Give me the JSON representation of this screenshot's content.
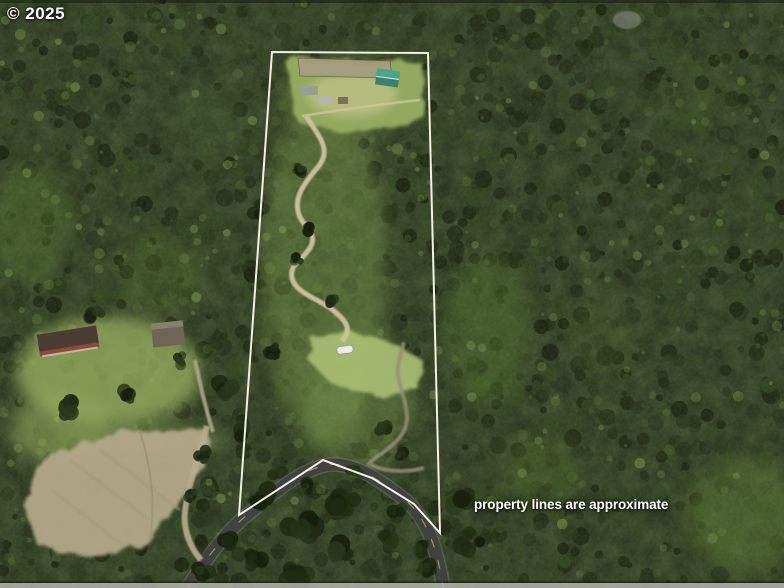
{
  "watermark": {
    "text": "© 2025"
  },
  "disclaimer": {
    "text": "property lines are approximate"
  },
  "palette": {
    "forest_base": "#222e18",
    "forest_dark": "#17210e",
    "forest_mid": "#31451f",
    "forest_light": "#527031",
    "brush_light": "#87a653",
    "meadow": "#aabf74",
    "grass_clearing": "#97ad60",
    "dirt_field": "#b3a88a",
    "dirt_road": "#cfc3a0",
    "paved_road": "#3f423f",
    "road_centerline": "#d8c24a",
    "creek": "#978d79",
    "boundary_line": "#faf8ea",
    "barn_roof": "#4aa38b",
    "barn_roof_shade": "#37826d",
    "shed_gray": "#98a095",
    "shed_light": "#b3b6ad",
    "shed_brown": "#7a6f5c",
    "house_roof_dark": "#4b3c33",
    "house_wall_red": "#8a4a3a",
    "house2_roof": "#6f6557",
    "trailer_white": "#ecece4",
    "corral_dirt": "#a59c7e",
    "rock_gray": "#868b80",
    "bottom_strip": "#b4b4ac",
    "text_color": "#ffffff"
  },
  "scene": {
    "boundary_points": "272,52 428,53 440,533 414,504 372,478 323,460 239,515",
    "paved_road_d": "M185,592 C206,558 226,532 247,515 C272,494 300,470 327,465 C352,461 380,480 404,499 C428,518 438,552 444,592",
    "gravel_road_d": "M207,426 C200,455 188,484 185,511 C183,530 190,547 201,560",
    "dirt_road_d": "M306,116 C320,138 332,150 318,167 C300,188 294,200 299,215 C305,229 317,233 311,246 C304,260 289,263 292,278 C296,294 320,299 334,311 C349,323 351,331 342,341",
    "driveway_d": "M195,360 C200,384 206,410 213,432",
    "creek_d": "M404,342 C399,360 396,368 399,381 C405,404 413,421 400,437 C389,451 376,455 369,464 C380,470 400,474 424,468",
    "clearing_path_d": "M302,116 C340,110 380,104 420,100",
    "top_clearing_points": "284,60 422,62 425,118 398,126 340,132 298,122",
    "corral_points": "298,58 390,61 392,78 300,76",
    "meadow_points": "312,338 352,332 398,345 424,362 418,388 378,398 330,382 308,360",
    "dirt_field_points": "44,456 122,432 204,430 214,444 197,477 170,510 149,539 95,559 40,547 24,506"
  }
}
